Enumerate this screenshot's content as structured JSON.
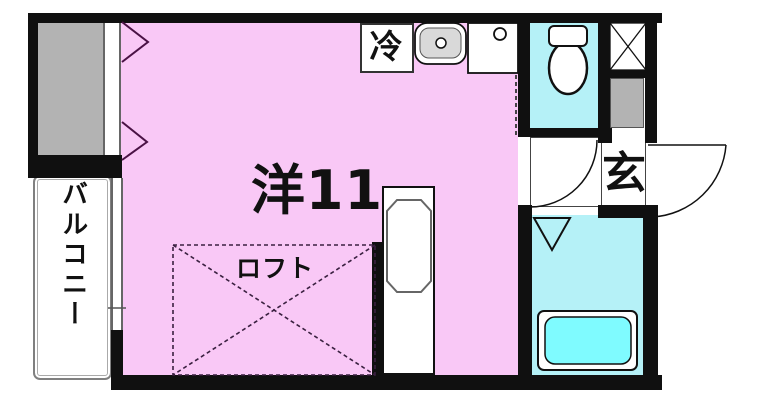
{
  "floorplan": {
    "labels": {
      "main_room": "洋11",
      "loft": "ロフト",
      "balcony": "バルコニー",
      "refrigerator": "冷",
      "entrance": "玄"
    },
    "colors": {
      "main_room_pink": "#F9C8F6",
      "wet_area_cyan": "#B5F1F7",
      "bathtub_aqua": "#7FFBFF",
      "storage_gray": "#B3B3B3",
      "wall_black": "#101010",
      "window_arrow_purple": "#4A1245"
    },
    "icons": {
      "toilet": "toilet-icon",
      "kitchen_sink": "kitchen-sink-icon",
      "stove": "stove-burner-icon",
      "bathtub": "bathtub-icon",
      "pipe_space": "pipe-space-x-icon",
      "washroom_door": "door-swing-arc-icon",
      "entrance_door": "door-swing-arc-icon",
      "bathroom_door": "door-triangle-icon",
      "window": "window-arrow-icon",
      "loft_area": "loft-dashed-x-icon"
    }
  }
}
